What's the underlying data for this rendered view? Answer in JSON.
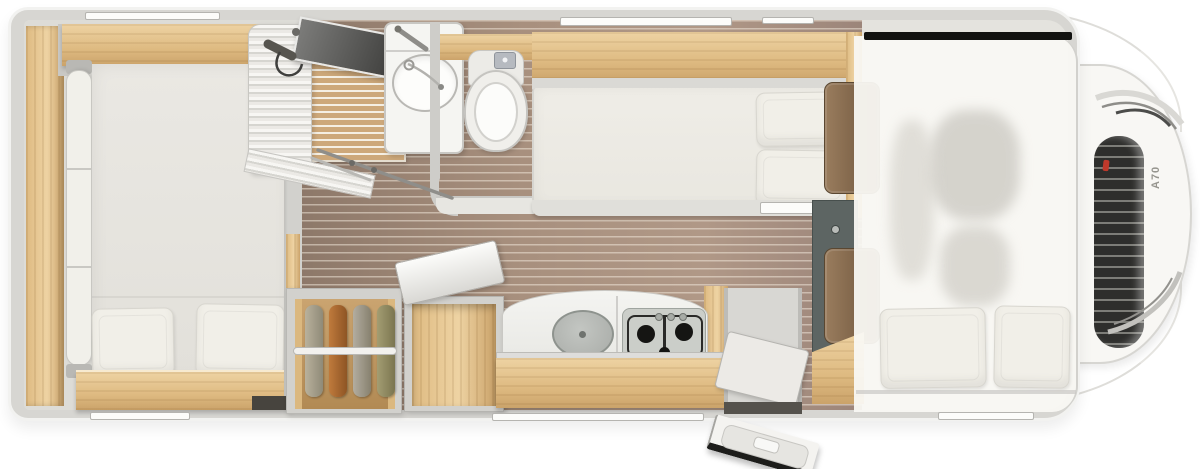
{
  "vehicle": {
    "model_badge": "A70",
    "kind": "alcove motorhome floor plan, top view"
  },
  "colors": {
    "body_rim": "#d7d6d2",
    "body_edge": "#f2f2f0",
    "interior": "#e4e3de",
    "wood_light": "#eed3a3",
    "wood_mid": "#deba81",
    "wood_deep": "#cba36a",
    "teak": "#cda87a",
    "teak_gap": "#f5efe3",
    "wall": "#d2d1cd",
    "mattress": "#edebe5",
    "pillow": "#f1efe8",
    "slate": "#5d6563",
    "seat_brown": "#9a7d5e",
    "seat_brown_dark": "#6b523a",
    "grille": "#2e2e2c",
    "chrome": "#c7c6c2",
    "badge_red": "#c0392b",
    "badge_text": "#96958e",
    "garment_1": "#b9b19c",
    "garment_2": "#bf7a3c",
    "garment_3": "#b3ada0",
    "garment_4": "#a39d72"
  },
  "floorplan": {
    "areas": [
      {
        "id": "rear-bedroom",
        "label": "rear bedroom with bed and two pillows"
      },
      {
        "id": "shower",
        "label": "corner shower with folding curtain and teak grate"
      },
      {
        "id": "washroom",
        "label": "washbasin and cassette toilet"
      },
      {
        "id": "corridor",
        "label": "central aisle with wood plank floor"
      },
      {
        "id": "wardrobe",
        "label": "open wardrobe with four hanging garments"
      },
      {
        "id": "kitchen",
        "label": "kitchenette with sink lid and 3-burner gas hob"
      },
      {
        "id": "single-bed",
        "label": "lengthwise single bed / sofa with bolster cushions"
      },
      {
        "id": "entrance",
        "label": "entry step well with door swung open"
      },
      {
        "id": "alcove-bed",
        "label": "over-cab alcove double bed with two pillows"
      },
      {
        "id": "driver-cab",
        "label": "driver cab seen through translucent alcove floor"
      }
    ],
    "fixtures": [
      "overhead-lockers",
      "washbasin",
      "toilet",
      "shower-head",
      "towel-rail",
      "clothes-rail",
      "top-loading-compartment",
      "kitchen-drawer",
      "cab-seats",
      "front-grille",
      "headlight",
      "entry-door"
    ]
  }
}
